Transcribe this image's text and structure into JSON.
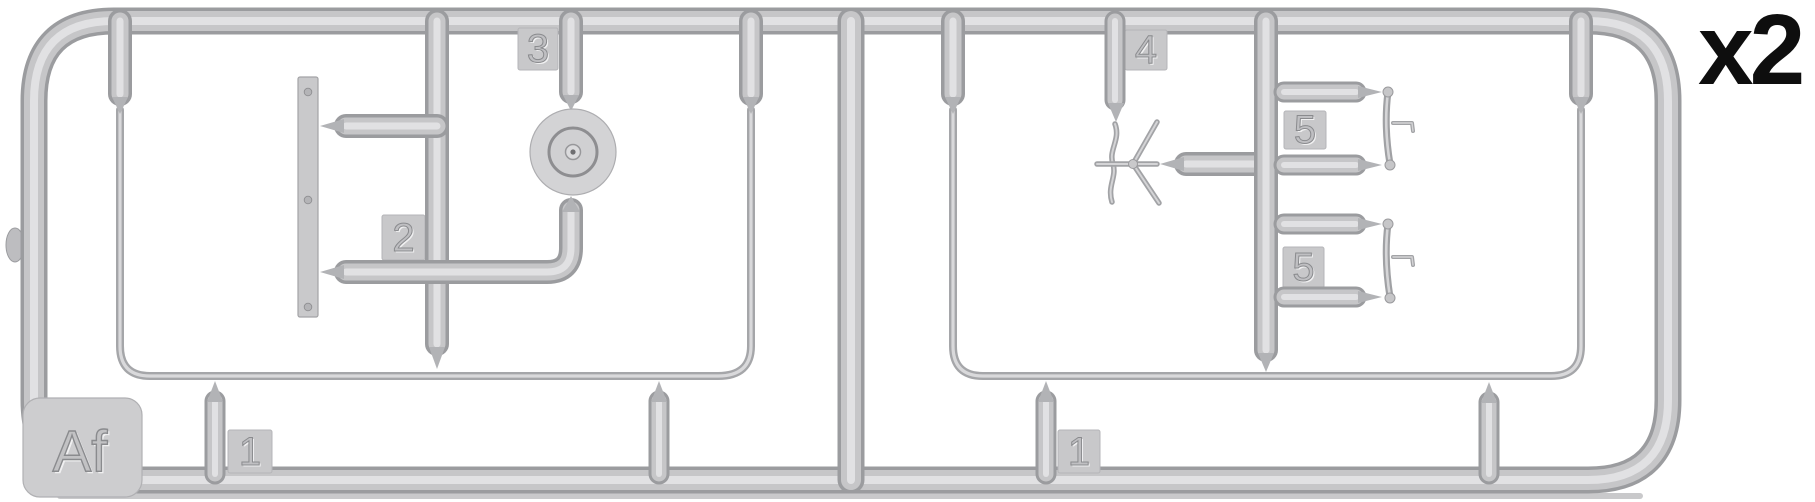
{
  "diagram": {
    "type": "model-kit-sprue-map",
    "sprue_letter": "Af",
    "quantity": "x2",
    "labels": {
      "part1_left": "1",
      "part2": "2",
      "part3": "3",
      "part4": "4",
      "part5_top": "5",
      "part5_bottom": "5",
      "part1_right": "1"
    },
    "colors": {
      "background": "#ffffff",
      "plastic_mid": "#c6c6c8",
      "plastic_edge": "#9b9c9f",
      "plastic_highlight": "#e1e1e3",
      "label_plate": "#c8c8ca",
      "engraved_digit": "#bfbfc2",
      "quantity_text": "#0e0e0e"
    }
  }
}
